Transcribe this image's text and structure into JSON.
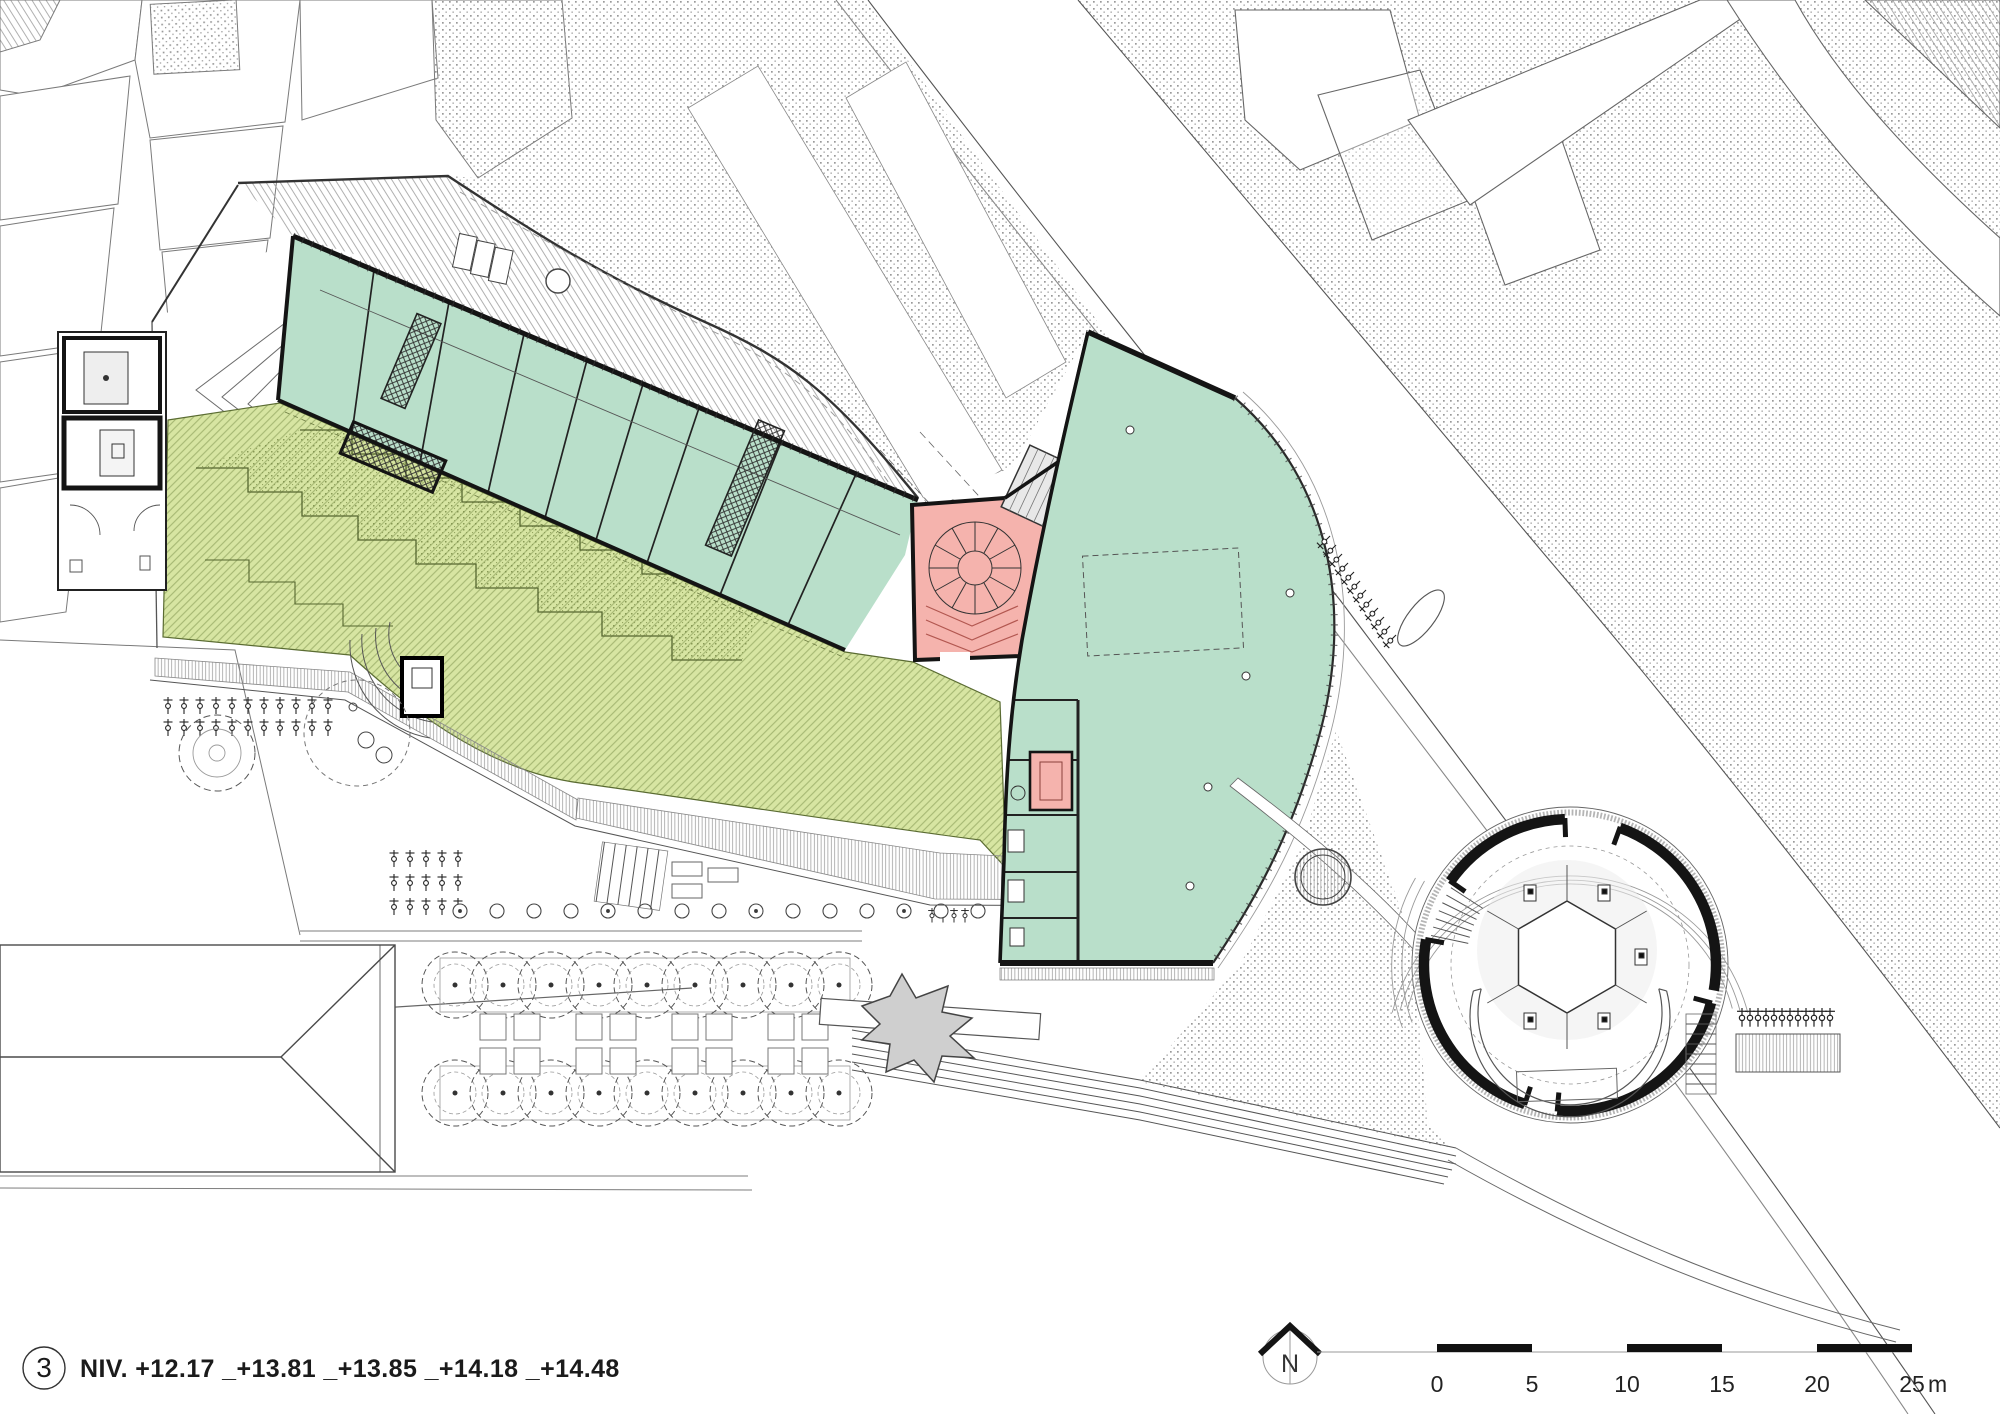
{
  "sheet": {
    "badge_number": "3",
    "level_caption": "NIV. +12.17 _+13.81 _+13.85 _+14.18 _+14.48",
    "north_label": "N",
    "scale_bar": {
      "tick_labels": [
        "0",
        "5",
        "10",
        "15",
        "20",
        "25"
      ],
      "unit": "m"
    }
  },
  "colors": {
    "paper": "#ffffff",
    "ink": "#141414",
    "line": "#555555",
    "light_line": "#9a9a9a",
    "green_roof": "#d7e5a2",
    "green_line": "#5a6b32",
    "teal_room": "#b9dfca",
    "teal_line": "#3f7a60",
    "pink_room": "#f5b3ad",
    "pink_line": "#b25750",
    "gray_fill": "#e8e8e8",
    "stipple": "#9a9a9a"
  }
}
